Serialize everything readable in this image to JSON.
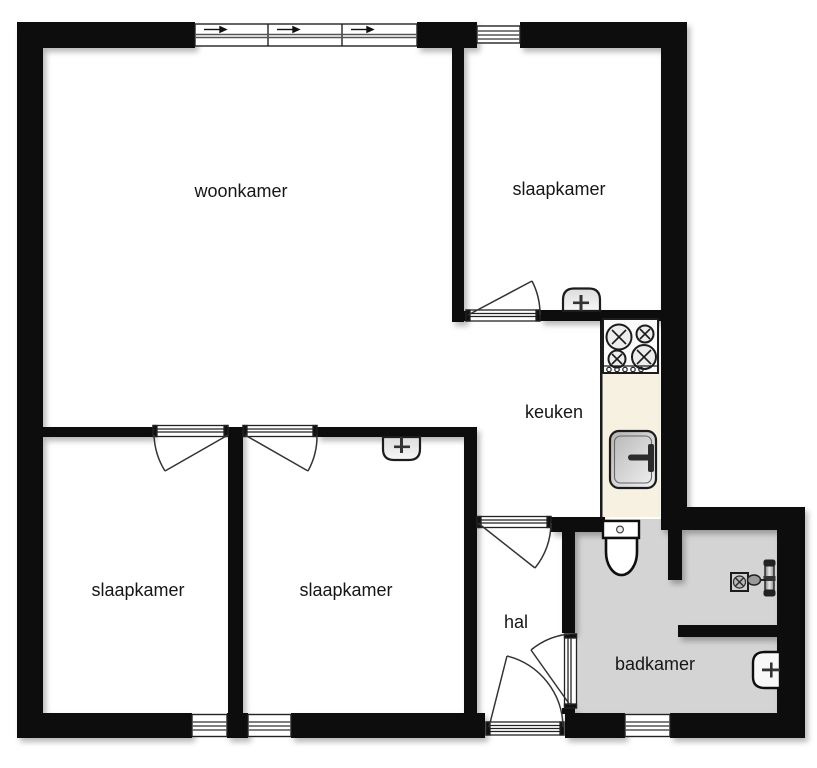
{
  "title": "floor-plan",
  "rooms": [
    {
      "id": "woonkamer",
      "label": "woonkamer"
    },
    {
      "id": "slaapkamer-top",
      "label": "slaapkamer"
    },
    {
      "id": "keuken",
      "label": "keuken"
    },
    {
      "id": "slaapkamer-left",
      "label": "slaapkamer"
    },
    {
      "id": "slaapkamer-middle",
      "label": "slaapkamer"
    },
    {
      "id": "hal",
      "label": "hal"
    },
    {
      "id": "badkamer",
      "label": "badkamer"
    }
  ],
  "fixtures": [
    "stove-4-burners",
    "kitchen-sink",
    "toilet",
    "washbasin-bedroom-top",
    "washbasin-bedroom-middle",
    "bathroom-washbasin",
    "shower-drain",
    "shower-mixer"
  ],
  "colors": {
    "wall": "#0a0a0a",
    "floor": "#ffffff",
    "bathroom_floor": "#d4d4d4",
    "kitchen_counter": "#f6f1e1",
    "line": "#2a2a2a",
    "fixture_fill": "#ececec"
  }
}
